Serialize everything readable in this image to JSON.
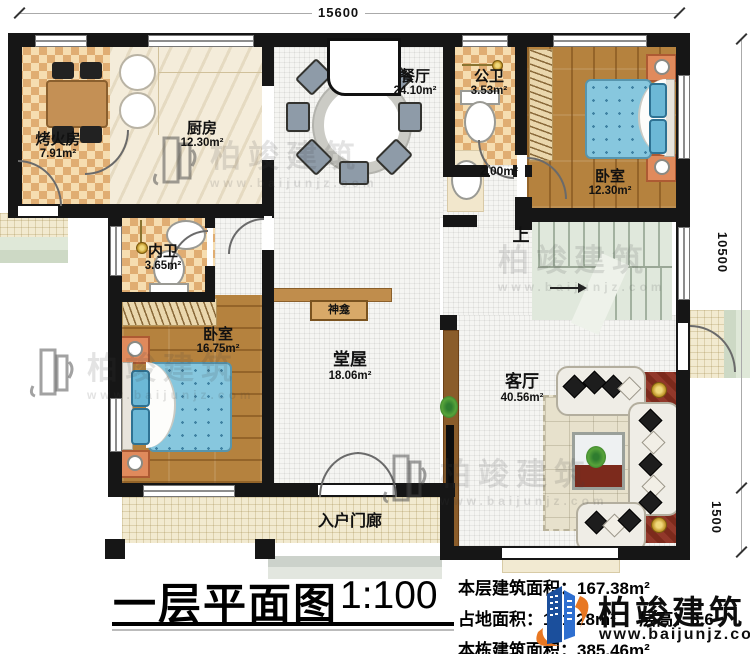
{
  "plan": {
    "dim_top": "15600",
    "dim_right_upper": "10500",
    "dim_right_lower": "1500",
    "rooms": {
      "kaohuofang": {
        "name": "烤火房",
        "area": "7.91m²"
      },
      "chufang": {
        "name": "厨房",
        "area": "12.30m²"
      },
      "canting": {
        "name": "餐厅",
        "area": "24.10m²"
      },
      "gongwei": {
        "name": "公卫",
        "area": "3.53m²"
      },
      "xishou": {
        "area": "2.00m²"
      },
      "woshi_youshang": {
        "name": "卧室",
        "area": "12.30m²"
      },
      "neiwei": {
        "name": "内卫",
        "area": "3.65m²"
      },
      "woshi_zuoxia": {
        "name": "卧室",
        "area": "16.75m²"
      },
      "tangwu": {
        "name": "堂屋",
        "area": "18.06m²"
      },
      "keting": {
        "name": "客厅",
        "area": "40.56m²"
      },
      "shenkan": {
        "name": "神龛"
      },
      "rumen": {
        "name": "入户门廊"
      },
      "stairs_up": {
        "label": "上"
      }
    }
  },
  "footer": {
    "title": "一层平面图",
    "scale": "1:100",
    "stats": {
      "floor_area_label": "本层建筑面积：",
      "floor_area_value": "167.38m²",
      "land_area_label": "占地面积：",
      "land_area_value": "181.28m²",
      "height_label": "层高：",
      "height_value": "3.6",
      "total_area_label": "本栋建筑面积：",
      "total_area_value": "385.46m²"
    },
    "brand": {
      "name": "柏竣建筑",
      "url": "www.baijunjz.com"
    }
  },
  "watermark": {
    "name": "柏竣建筑",
    "url": "www.baijunjz.com"
  }
}
